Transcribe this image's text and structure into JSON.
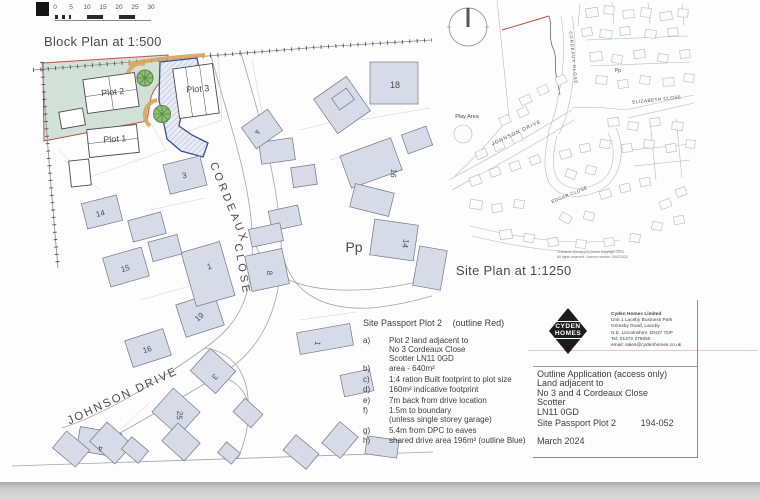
{
  "colors": {
    "plot_land_green": "#cfe0d6",
    "red_outline": "#c0483b",
    "drive_blue_outline": "#35509b",
    "drive_hatch": "#a9b3d6",
    "drive_fill": "#e9ecf5",
    "landscape_orange": "#dda45c",
    "tree_green": "#8cbd77",
    "tree_stroke": "#58853f",
    "house_fill": "#d7dbe8",
    "road_line": "#a0a5ad"
  },
  "scale_bar": {
    "ticks": [
      "0",
      "5",
      "10",
      "15",
      "20",
      "25",
      "30"
    ]
  },
  "block_plan": {
    "title": "Block Plan at 1:500",
    "houses": [
      {
        "x": 84,
        "y": 199,
        "w": 36,
        "h": 26,
        "r": -14
      },
      {
        "x": 106,
        "y": 252,
        "w": 40,
        "h": 30,
        "r": -16
      },
      {
        "x": 128,
        "y": 334,
        "w": 40,
        "h": 28,
        "r": -18
      },
      {
        "x": 180,
        "y": 298,
        "w": 40,
        "h": 34,
        "r": -18
      },
      {
        "x": 196,
        "y": 356,
        "w": 34,
        "h": 30,
        "r": 42
      },
      {
        "x": 158,
        "y": 396,
        "w": 36,
        "h": 32,
        "r": 42
      },
      {
        "x": 78,
        "y": 430,
        "w": 42,
        "h": 24,
        "r": 10
      },
      {
        "x": 166,
        "y": 160,
        "w": 38,
        "h": 30,
        "r": -14
      },
      {
        "x": 248,
        "y": 252,
        "w": 38,
        "h": 36,
        "r": -12
      },
      {
        "x": 188,
        "y": 246,
        "w": 40,
        "h": 56,
        "r": -16
      },
      {
        "x": 370,
        "y": 62,
        "w": 48,
        "h": 42,
        "r": 0
      },
      {
        "x": 322,
        "y": 84,
        "w": 40,
        "h": 42,
        "r": -35
      },
      {
        "x": 344,
        "y": 146,
        "w": 54,
        "h": 34,
        "r": -20
      },
      {
        "x": 372,
        "y": 222,
        "w": 44,
        "h": 36,
        "r": 8
      },
      {
        "x": 352,
        "y": 188,
        "w": 40,
        "h": 24,
        "r": 14
      },
      {
        "x": 260,
        "y": 140,
        "w": 34,
        "h": 22,
        "r": -8
      },
      {
        "x": 292,
        "y": 166,
        "w": 24,
        "h": 20,
        "r": -8
      },
      {
        "x": 246,
        "y": 116,
        "w": 32,
        "h": 26,
        "r": -35
      },
      {
        "x": 298,
        "y": 328,
        "w": 54,
        "h": 22,
        "r": -10
      },
      {
        "x": 130,
        "y": 216,
        "w": 34,
        "h": 22,
        "r": -15
      },
      {
        "x": 150,
        "y": 238,
        "w": 30,
        "h": 20,
        "r": -15
      },
      {
        "x": 56,
        "y": 438,
        "w": 30,
        "h": 22,
        "r": 40
      },
      {
        "x": 94,
        "y": 430,
        "w": 34,
        "h": 26,
        "r": 42
      },
      {
        "x": 124,
        "y": 442,
        "w": 22,
        "h": 16,
        "r": 40
      },
      {
        "x": 166,
        "y": 430,
        "w": 30,
        "h": 24,
        "r": 42
      },
      {
        "x": 286,
        "y": 442,
        "w": 30,
        "h": 20,
        "r": 40
      },
      {
        "x": 328,
        "y": 426,
        "w": 24,
        "h": 28,
        "r": 40
      },
      {
        "x": 220,
        "y": 446,
        "w": 18,
        "h": 14,
        "r": 40
      },
      {
        "x": 366,
        "y": 438,
        "w": 32,
        "h": 18,
        "r": 8
      },
      {
        "x": 416,
        "y": 248,
        "w": 28,
        "h": 40,
        "r": 10
      },
      {
        "x": 334,
        "y": 92,
        "w": 18,
        "h": 14,
        "r": -35
      },
      {
        "x": 270,
        "y": 208,
        "w": 30,
        "h": 20,
        "r": -12
      },
      {
        "x": 250,
        "y": 226,
        "w": 32,
        "h": 18,
        "r": -12
      },
      {
        "x": 404,
        "y": 130,
        "w": 26,
        "h": 20,
        "r": -20
      },
      {
        "x": 342,
        "y": 372,
        "w": 30,
        "h": 22,
        "r": -12
      },
      {
        "x": 236,
        "y": 404,
        "w": 24,
        "h": 18,
        "r": 42
      }
    ],
    "labels": [
      {
        "t": "Plot 2",
        "x": 113,
        "y": 95,
        "r": -6,
        "s": 9,
        "n": "plot-2-label"
      },
      {
        "t": "Plot 1",
        "x": 115,
        "y": 142,
        "r": -4,
        "s": 9,
        "n": "plot-1-label"
      },
      {
        "t": "Plot 3",
        "x": 198,
        "y": 92,
        "r": -4,
        "s": 9,
        "n": "plot-3-label"
      },
      {
        "t": "14",
        "x": 101,
        "y": 216,
        "r": -14,
        "s": 8
      },
      {
        "t": "15",
        "x": 126,
        "y": 271,
        "r": -16,
        "s": 8
      },
      {
        "t": "16",
        "x": 148,
        "y": 352,
        "r": -18,
        "s": 8
      },
      {
        "t": "19",
        "x": 201,
        "y": 319,
        "r": -40,
        "s": 8
      },
      {
        "t": "3",
        "x": 213,
        "y": 375,
        "r": 135,
        "s": 8
      },
      {
        "t": "25",
        "x": 177,
        "y": 415,
        "r": 95,
        "s": 8
      },
      {
        "t": "4",
        "x": 100,
        "y": 446,
        "r": 170,
        "s": 8
      },
      {
        "t": "3",
        "x": 185,
        "y": 178,
        "r": -14,
        "s": 8
      },
      {
        "t": "8",
        "x": 267,
        "y": 273,
        "r": 88,
        "s": 8
      },
      {
        "t": "1",
        "x": 210,
        "y": 269,
        "r": -16,
        "s": 8
      },
      {
        "t": "18",
        "x": 395,
        "y": 88,
        "r": 0,
        "s": 9
      },
      {
        "t": "16",
        "x": 391,
        "y": 173,
        "r": 95,
        "s": 8
      },
      {
        "t": "14",
        "x": 403,
        "y": 243,
        "r": 100,
        "s": 8
      },
      {
        "t": "4",
        "x": 255,
        "y": 131,
        "r": 110,
        "s": 7.5
      },
      {
        "t": "1",
        "x": 315,
        "y": 343,
        "r": 100,
        "s": 8
      },
      {
        "t": "Pp",
        "x": 354,
        "y": 252,
        "r": 0,
        "s": 14,
        "n": "pp-label"
      },
      {
        "t": "CORDEAUX",
        "x": 226,
        "y": 204,
        "r": 68,
        "s": 11,
        "ls": 3,
        "n": "street-label-cordeaux"
      },
      {
        "t": "CLOSE",
        "x": 239,
        "y": 270,
        "r": 80,
        "s": 11,
        "ls": 3,
        "n": "street-label-close"
      },
      {
        "t": "JOHNSON DRIVE",
        "x": 124,
        "y": 399,
        "r": -25,
        "s": 11.5,
        "ls": 2,
        "n": "street-label-johnson-drive"
      }
    ]
  },
  "site_plan": {
    "title": "Site Plan at 1:1250",
    "houses": [
      {
        "x": 586,
        "y": 8,
        "w": 12,
        "h": 9,
        "r": -8
      },
      {
        "x": 604,
        "y": 6,
        "w": 10,
        "h": 8,
        "r": 4
      },
      {
        "x": 623,
        "y": 10,
        "w": 11,
        "h": 8,
        "r": -4
      },
      {
        "x": 641,
        "y": 8,
        "w": 10,
        "h": 9,
        "r": 6
      },
      {
        "x": 660,
        "y": 12,
        "w": 12,
        "h": 8,
        "r": -6
      },
      {
        "x": 678,
        "y": 9,
        "w": 10,
        "h": 8,
        "r": 3
      },
      {
        "x": 582,
        "y": 28,
        "w": 10,
        "h": 8,
        "r": -10
      },
      {
        "x": 600,
        "y": 30,
        "w": 12,
        "h": 8,
        "r": 5
      },
      {
        "x": 620,
        "y": 27,
        "w": 10,
        "h": 8,
        "r": -5
      },
      {
        "x": 645,
        "y": 30,
        "w": 11,
        "h": 8,
        "r": 8
      },
      {
        "x": 668,
        "y": 28,
        "w": 10,
        "h": 8,
        "r": -4
      },
      {
        "x": 590,
        "y": 52,
        "w": 12,
        "h": 9,
        "r": -6
      },
      {
        "x": 612,
        "y": 55,
        "w": 10,
        "h": 8,
        "r": 6
      },
      {
        "x": 634,
        "y": 50,
        "w": 11,
        "h": 8,
        "r": -8
      },
      {
        "x": 658,
        "y": 54,
        "w": 10,
        "h": 8,
        "r": 5
      },
      {
        "x": 680,
        "y": 50,
        "w": 10,
        "h": 8,
        "r": -5
      },
      {
        "x": 596,
        "y": 76,
        "w": 11,
        "h": 8,
        "r": 4
      },
      {
        "x": 618,
        "y": 80,
        "w": 10,
        "h": 8,
        "r": -6
      },
      {
        "x": 640,
        "y": 76,
        "w": 10,
        "h": 8,
        "r": 6
      },
      {
        "x": 663,
        "y": 78,
        "w": 11,
        "h": 8,
        "r": -3
      },
      {
        "x": 684,
        "y": 74,
        "w": 10,
        "h": 8,
        "r": 4
      },
      {
        "x": 608,
        "y": 118,
        "w": 11,
        "h": 8,
        "r": -6
      },
      {
        "x": 628,
        "y": 122,
        "w": 10,
        "h": 8,
        "r": 5
      },
      {
        "x": 650,
        "y": 118,
        "w": 10,
        "h": 8,
        "r": -5
      },
      {
        "x": 672,
        "y": 122,
        "w": 11,
        "h": 8,
        "r": 6
      },
      {
        "x": 600,
        "y": 140,
        "w": 10,
        "h": 8,
        "r": 8
      },
      {
        "x": 622,
        "y": 144,
        "w": 10,
        "h": 8,
        "r": -6
      },
      {
        "x": 644,
        "y": 140,
        "w": 10,
        "h": 8,
        "r": 4
      },
      {
        "x": 666,
        "y": 144,
        "w": 10,
        "h": 8,
        "r": -8
      },
      {
        "x": 686,
        "y": 140,
        "w": 9,
        "h": 8,
        "r": 5
      },
      {
        "x": 520,
        "y": 96,
        "w": 11,
        "h": 8,
        "r": -24
      },
      {
        "x": 538,
        "y": 86,
        "w": 10,
        "h": 8,
        "r": -24
      },
      {
        "x": 556,
        "y": 76,
        "w": 10,
        "h": 8,
        "r": -24
      },
      {
        "x": 500,
        "y": 116,
        "w": 10,
        "h": 8,
        "r": -24
      },
      {
        "x": 518,
        "y": 108,
        "w": 10,
        "h": 8,
        "r": -24
      },
      {
        "x": 476,
        "y": 150,
        "w": 11,
        "h": 8,
        "r": -24
      },
      {
        "x": 494,
        "y": 142,
        "w": 10,
        "h": 8,
        "r": -24
      },
      {
        "x": 512,
        "y": 134,
        "w": 10,
        "h": 8,
        "r": -24
      },
      {
        "x": 470,
        "y": 176,
        "w": 11,
        "h": 9,
        "r": -20
      },
      {
        "x": 490,
        "y": 168,
        "w": 10,
        "h": 8,
        "r": -20
      },
      {
        "x": 510,
        "y": 162,
        "w": 10,
        "h": 8,
        "r": -20
      },
      {
        "x": 530,
        "y": 156,
        "w": 10,
        "h": 8,
        "r": -20
      },
      {
        "x": 470,
        "y": 200,
        "w": 12,
        "h": 9,
        "r": 10
      },
      {
        "x": 492,
        "y": 204,
        "w": 10,
        "h": 8,
        "r": -8
      },
      {
        "x": 514,
        "y": 200,
        "w": 10,
        "h": 8,
        "r": 6
      },
      {
        "x": 560,
        "y": 150,
        "w": 11,
        "h": 8,
        "r": -15
      },
      {
        "x": 580,
        "y": 144,
        "w": 10,
        "h": 8,
        "r": -12
      },
      {
        "x": 566,
        "y": 170,
        "w": 10,
        "h": 8,
        "r": 20
      },
      {
        "x": 586,
        "y": 166,
        "w": 10,
        "h": 8,
        "r": 14
      },
      {
        "x": 600,
        "y": 190,
        "w": 11,
        "h": 8,
        "r": -18
      },
      {
        "x": 620,
        "y": 184,
        "w": 10,
        "h": 8,
        "r": -14
      },
      {
        "x": 640,
        "y": 178,
        "w": 10,
        "h": 8,
        "r": -10
      },
      {
        "x": 560,
        "y": 214,
        "w": 11,
        "h": 8,
        "r": 30
      },
      {
        "x": 584,
        "y": 212,
        "w": 10,
        "h": 8,
        "r": 16
      },
      {
        "x": 500,
        "y": 230,
        "w": 12,
        "h": 9,
        "r": -6
      },
      {
        "x": 524,
        "y": 234,
        "w": 10,
        "h": 8,
        "r": 8
      },
      {
        "x": 548,
        "y": 238,
        "w": 10,
        "h": 8,
        "r": -8
      },
      {
        "x": 576,
        "y": 240,
        "w": 10,
        "h": 8,
        "r": 6
      },
      {
        "x": 604,
        "y": 238,
        "w": 10,
        "h": 8,
        "r": -6
      },
      {
        "x": 630,
        "y": 234,
        "w": 10,
        "h": 8,
        "r": 8
      },
      {
        "x": 660,
        "y": 200,
        "w": 11,
        "h": 8,
        "r": -20
      },
      {
        "x": 676,
        "y": 188,
        "w": 10,
        "h": 8,
        "r": -20
      },
      {
        "x": 652,
        "y": 222,
        "w": 10,
        "h": 8,
        "r": 12
      },
      {
        "x": 674,
        "y": 216,
        "w": 10,
        "h": 8,
        "r": -10
      }
    ],
    "labels": [
      {
        "t": "CORDEAUX  CLOSE",
        "x": 572,
        "y": 58,
        "r": 84,
        "s": 4.2,
        "ls": 1,
        "n": "sp-street-label-cordeaux-close"
      },
      {
        "t": "ELIZABETH CLOSE",
        "x": 657,
        "y": 101,
        "r": -6,
        "s": 4.6,
        "ls": 0.5,
        "n": "sp-street-label-elizabeth-close"
      },
      {
        "t": "JOHNSON DRIVE",
        "x": 517,
        "y": 134,
        "r": -25,
        "s": 5,
        "ls": 1,
        "n": "sp-street-label-johnson-drive"
      },
      {
        "t": "EDGAR CLOSE",
        "x": 570,
        "y": 196,
        "r": -22,
        "s": 4.6,
        "ls": 0.5,
        "n": "sp-street-label-edgar-close"
      },
      {
        "t": "Play Area",
        "x": 467,
        "y": 118,
        "r": 0,
        "s": 5.5,
        "ls": 0,
        "n": "sp-play-area-label"
      },
      {
        "t": "Pp",
        "x": 618,
        "y": 72,
        "r": 0,
        "s": 5,
        "ls": 0,
        "n": "sp-pp-label"
      }
    ],
    "copyright": [
      "Ordnance Survey (C) Crown Copyright 2024.",
      "All rights reserved. Licence number 100022432"
    ]
  },
  "site_passport": {
    "title": "Site Passport Plot 2",
    "suffix": "(outline Red)",
    "items": [
      {
        "label": "a)",
        "text": "Plot 2 land adjacent to\nNo 3 Cordeaux Close\nScotter LN11 0GD"
      },
      {
        "label": "b)",
        "text": "area - 640m²"
      },
      {
        "label": "c)",
        "text": "1:4 ration Built footprint to plot size"
      },
      {
        "label": "d)",
        "text": "160m² indicative footprint"
      },
      {
        "label": "e)",
        "text": "7m back from drive location"
      },
      {
        "label": "f)",
        "text": "1.5m to boundary\n(unless single storey garage)"
      },
      {
        "label": "g)",
        "text": "5.4m from DPC to eaves"
      },
      {
        "label": "h)",
        "text": "shared drive area 196m² (outline Blue)"
      }
    ]
  },
  "title_block": {
    "logo": {
      "line1": "CYDEN",
      "line2": "HOMES"
    },
    "company": [
      "Cyden Homes Limited",
      "Unit 1 Laceby Business Park",
      "Grimsby Road, Laceby",
      "N.E. Lincolnshire, DN37 7DP",
      "Tel: 01472 276650",
      "email: sales@cydenhomes.co.uk"
    ],
    "application": [
      "Outline Application (access only)",
      "Land adjacent to",
      "No 3 and 4 Cordeaux Close",
      "Scotter",
      "LN11 0GD"
    ],
    "doc_title": "Site Passport Plot 2",
    "doc_number": "194-052",
    "date": "March 2024"
  }
}
